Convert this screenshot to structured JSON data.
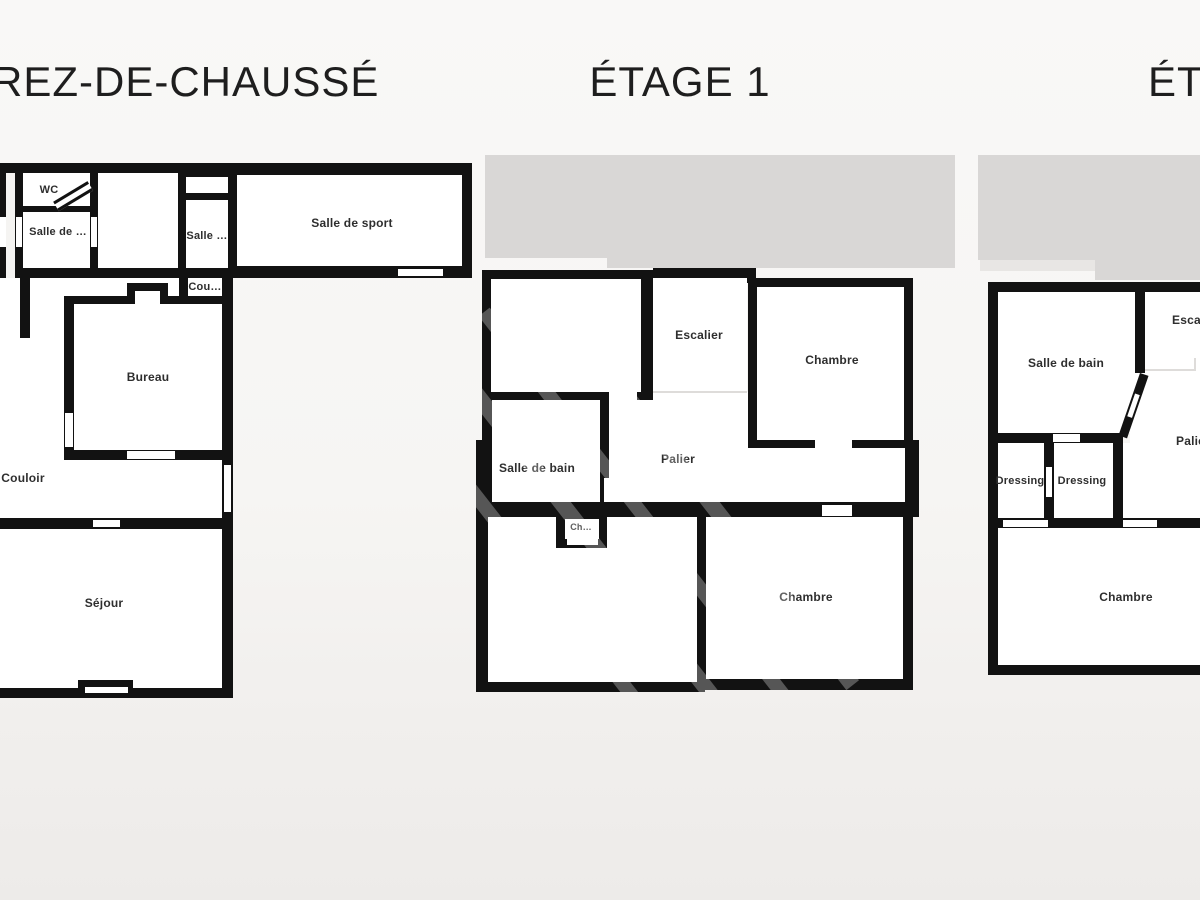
{
  "plans": {
    "ground": {
      "title": "REZ-DE-CHAUSSÉ",
      "rooms": {
        "wc": "WC",
        "salle_de": "Salle de …",
        "salle": "Salle …",
        "salle_de_sport": "Salle de sport",
        "cou": "Cou…",
        "bureau": "Bureau",
        "couloir": "Couloir",
        "sejour": "Séjour"
      }
    },
    "etage1": {
      "title": "ÉTAGE 1",
      "rooms": {
        "escalier": "Escalier",
        "chambre_haut": "Chambre",
        "salle_de_bain": "Salle de bain",
        "palier": "Palier",
        "ch": "Ch…",
        "chambre_bas": "Chambre"
      }
    },
    "etage2": {
      "title": "ÉTA",
      "rooms": {
        "salle_de_bain": "Salle de bain",
        "escalier": "Escalier",
        "palier": "Palier",
        "dressing_gauche": "Dressing",
        "dressing_droit": "Dressing",
        "chambre": "Chambre"
      }
    }
  },
  "colors": {
    "wall": "#121212",
    "room": "#ffffff",
    "bg": "#f5f4f2",
    "roof": "#d9d7d6",
    "roof_light": "#e8e6e4",
    "label": "#2e2e2e",
    "title": "#1e1e1e"
  }
}
